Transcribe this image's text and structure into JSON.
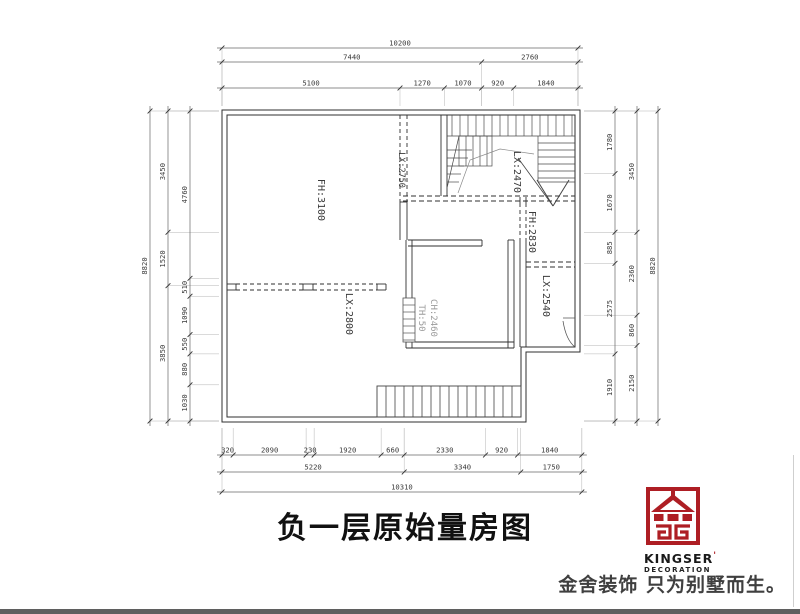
{
  "title": "负一层原始量房图",
  "rooms": [
    {
      "id": "fh3100",
      "label": "FH:3100"
    },
    {
      "id": "lx2750",
      "label": "LX:2750"
    },
    {
      "id": "lx2470",
      "label": "LX:2470"
    },
    {
      "id": "fh2830",
      "label": "FH:2830"
    },
    {
      "id": "lx2540",
      "label": "LX:2540"
    },
    {
      "id": "lx2800",
      "label": "LX:2800"
    },
    {
      "id": "ch2460",
      "label": "CH:2460"
    },
    {
      "id": "th50",
      "label": "TH:50"
    }
  ],
  "dimensions": {
    "top_rows": [
      [
        "10200"
      ],
      [
        "7440",
        "2760"
      ],
      [
        "5100",
        "1270",
        "1070",
        "920",
        "1840"
      ]
    ],
    "bottom_rows": [
      [
        "320",
        "2090",
        "230",
        "1920",
        "660",
        "2330",
        "920",
        "1840"
      ],
      [
        "5220",
        "3340",
        "1750"
      ],
      [
        "10310"
      ]
    ],
    "left_cols": [
      [
        "8820"
      ],
      [
        "3450",
        "1520",
        "3850"
      ],
      [
        "4760",
        "510",
        "1090",
        "550",
        "880",
        "1030"
      ]
    ],
    "right_cols": [
      [
        "1780",
        "1670",
        "885",
        "2575",
        "1910"
      ],
      [
        "3450",
        "2360",
        "860",
        "2150"
      ],
      [
        "8820"
      ]
    ]
  },
  "logo": {
    "brand": "KINGSER",
    "brand_mark": "'",
    "subtitle": "DECORATION",
    "tagline": "金舍装饰 只为别墅而生。"
  },
  "colors": {
    "line": "#2f2f2f",
    "stair": "#4a4a4a",
    "dim_line": "#666666",
    "dim_text": "#3a3a3a",
    "ext_line": "#b5b5b5",
    "light_text": "#9b9b9b",
    "logo_red": "#ae1e24"
  }
}
